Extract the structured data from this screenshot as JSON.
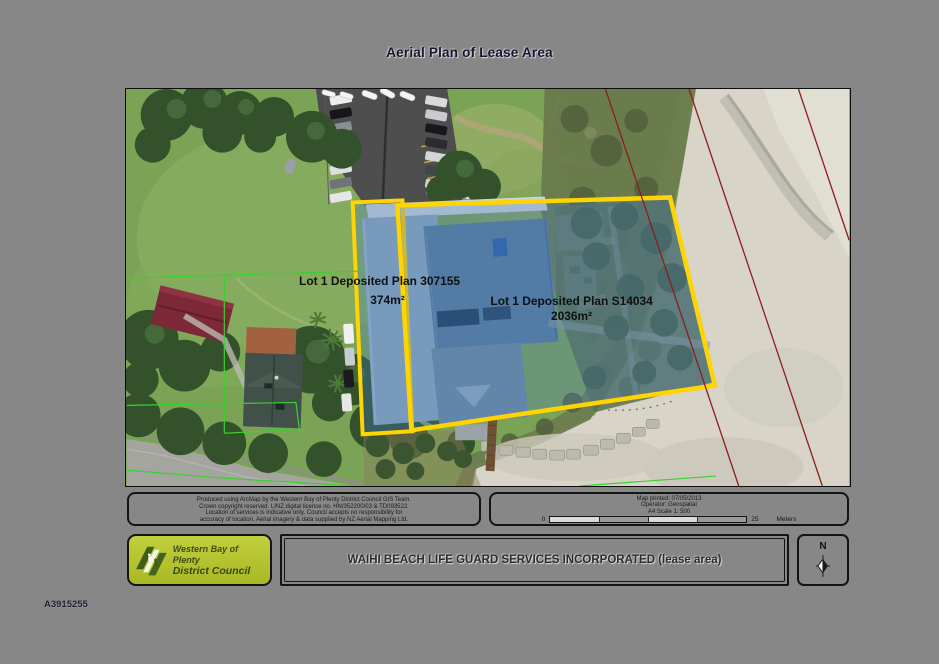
{
  "page": {
    "title": "Aerial Plan of Lease Area",
    "document_number": "A3915255"
  },
  "map": {
    "lot_small": {
      "name": "Lot 1 Deposited Plan 307155",
      "area": "374m²"
    },
    "lot_large": {
      "name": "Lot 1 Deposited Plan S14034",
      "area": "2036m²"
    }
  },
  "disclaimer": {
    "lines": [
      "Produced using ArcMap by the Western Bay of Plenty District Council GIS Team.",
      "Crown copyright reserved. LINZ digital licence no. HN/352200/03 & TD093522.",
      "Location of services is indicative only. Council accepts no responsibility for",
      "accuracy of location. Aerial imagery & data supplied by NZ Aerial Mapping Ltd."
    ]
  },
  "scale_panel": {
    "printed_line": "Map printed: 07/05/2013",
    "operator_line": "Operator: Geospatial",
    "scale_line": "A4 Scale 1: 500",
    "bar_zero": "0",
    "bar_end": "25",
    "units": "Meters"
  },
  "footer": {
    "logo_line1": "Western Bay of Plenty",
    "logo_line2": "District Council",
    "title": "WAIHI BEACH LIFE GUARD SERVICES INCORPORATED (lease area)",
    "north_label": "N"
  },
  "colors": {
    "background": "#878787",
    "lease_boundary": "#ffd400",
    "lease_fill": "rgba(70,125,195,0.30)",
    "cadastral_red": "#8c1d1d",
    "cadastral_green": "#39d12e",
    "logo_green": "#b5c42e"
  }
}
